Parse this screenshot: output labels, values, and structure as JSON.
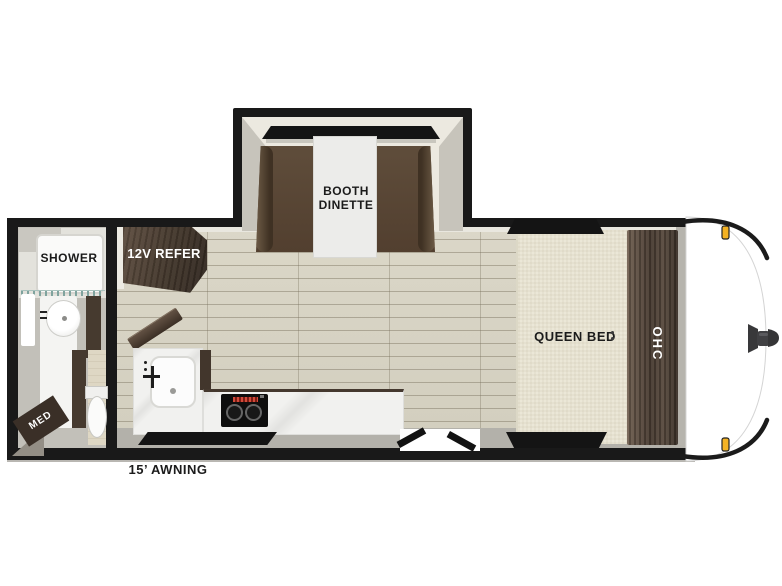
{
  "floorplan": {
    "type": "travel-trailer-floorplan",
    "labels": {
      "booth_line1": "BOOTH",
      "booth_line2": "DINETTE",
      "refer": "12V REFER",
      "shower": "SHOWER",
      "med": "MED",
      "queen_bed": "QUEEN BED",
      "ohc": "OHC",
      "awning": "15’ AWNING"
    },
    "colors": {
      "wall": "#191919",
      "dark_wood_cabinet": "#4a3c31",
      "floor_plank": "#d8d4c5",
      "bench_upholstery": "#5a4836",
      "bed_mattress": "#ebe7d7",
      "counter": "#f1f1ef",
      "marker_light": "#f4b223"
    }
  }
}
